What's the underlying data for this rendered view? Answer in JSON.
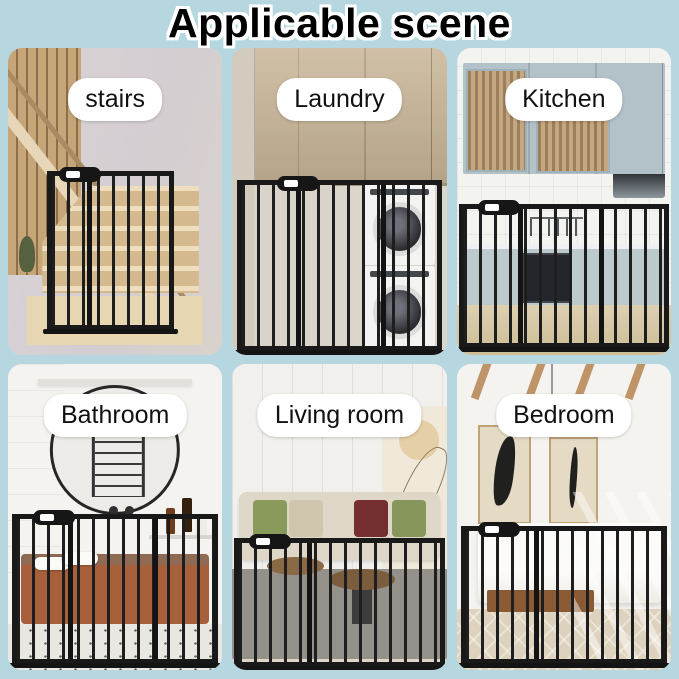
{
  "title": "Applicable scene",
  "colors": {
    "background": "#b6d7df",
    "label_background": "#ffffff",
    "label_text": "#111111",
    "title_text": "#000000",
    "title_outline": "#ffffff",
    "gate_metal": "#1a1a1a"
  },
  "panels": [
    {
      "id": "stairs",
      "label": "stairs"
    },
    {
      "id": "laundry",
      "label": "Laundry"
    },
    {
      "id": "kitchen",
      "label": "Kitchen"
    },
    {
      "id": "bathroom",
      "label": "Bathroom"
    },
    {
      "id": "living-room",
      "label": "Living room"
    },
    {
      "id": "bedroom",
      "label": "Bedroom"
    }
  ]
}
